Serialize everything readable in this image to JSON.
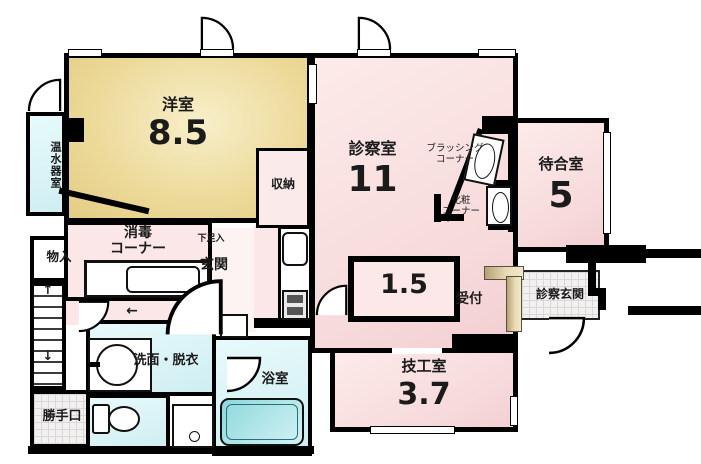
{
  "colors": {
    "wall": "#000000",
    "western_room_tan": "#ecd998",
    "room_pink": "#f7dadb",
    "wet_area_cyan": "#cfeef2",
    "tile_gray": "#f2f1ef",
    "counter_beige": "#e8dab4"
  },
  "rooms": {
    "yoshitsu": {
      "label": "洋室",
      "size": "8.5"
    },
    "onsuikishitsu": {
      "label": "温水器室"
    },
    "shinsatsushitsu": {
      "label": "診察室",
      "size": "11"
    },
    "machiaishitsu": {
      "label": "待合室",
      "size": "5"
    },
    "brushing_corner": {
      "label": "ブラッシング",
      "label2": "コーナー"
    },
    "keshou_corner": {
      "label": "化粧",
      "label2": "コーナー"
    },
    "shuunou": {
      "label": "収納"
    },
    "monoire": {
      "label": "物入"
    },
    "shoudoku_corner": {
      "label": "消毒",
      "label2": "コーナー"
    },
    "getabako": {
      "label": "下足入"
    },
    "genkan": {
      "label": "玄関"
    },
    "uketsuke": {
      "label": "受付"
    },
    "shinsatsu_genkan": {
      "label": "診察玄関"
    },
    "room_1_5": {
      "label": "1.5"
    },
    "gikoushitsu": {
      "label": "技工室",
      "size": "3.7"
    },
    "senmen_datsui": {
      "label": "洗面・脱衣"
    },
    "yokushitsu": {
      "label": "浴室"
    },
    "katteguchi": {
      "label": "勝手口"
    }
  },
  "arrows": {
    "up": "↑",
    "down": "↓",
    "left": "←"
  }
}
